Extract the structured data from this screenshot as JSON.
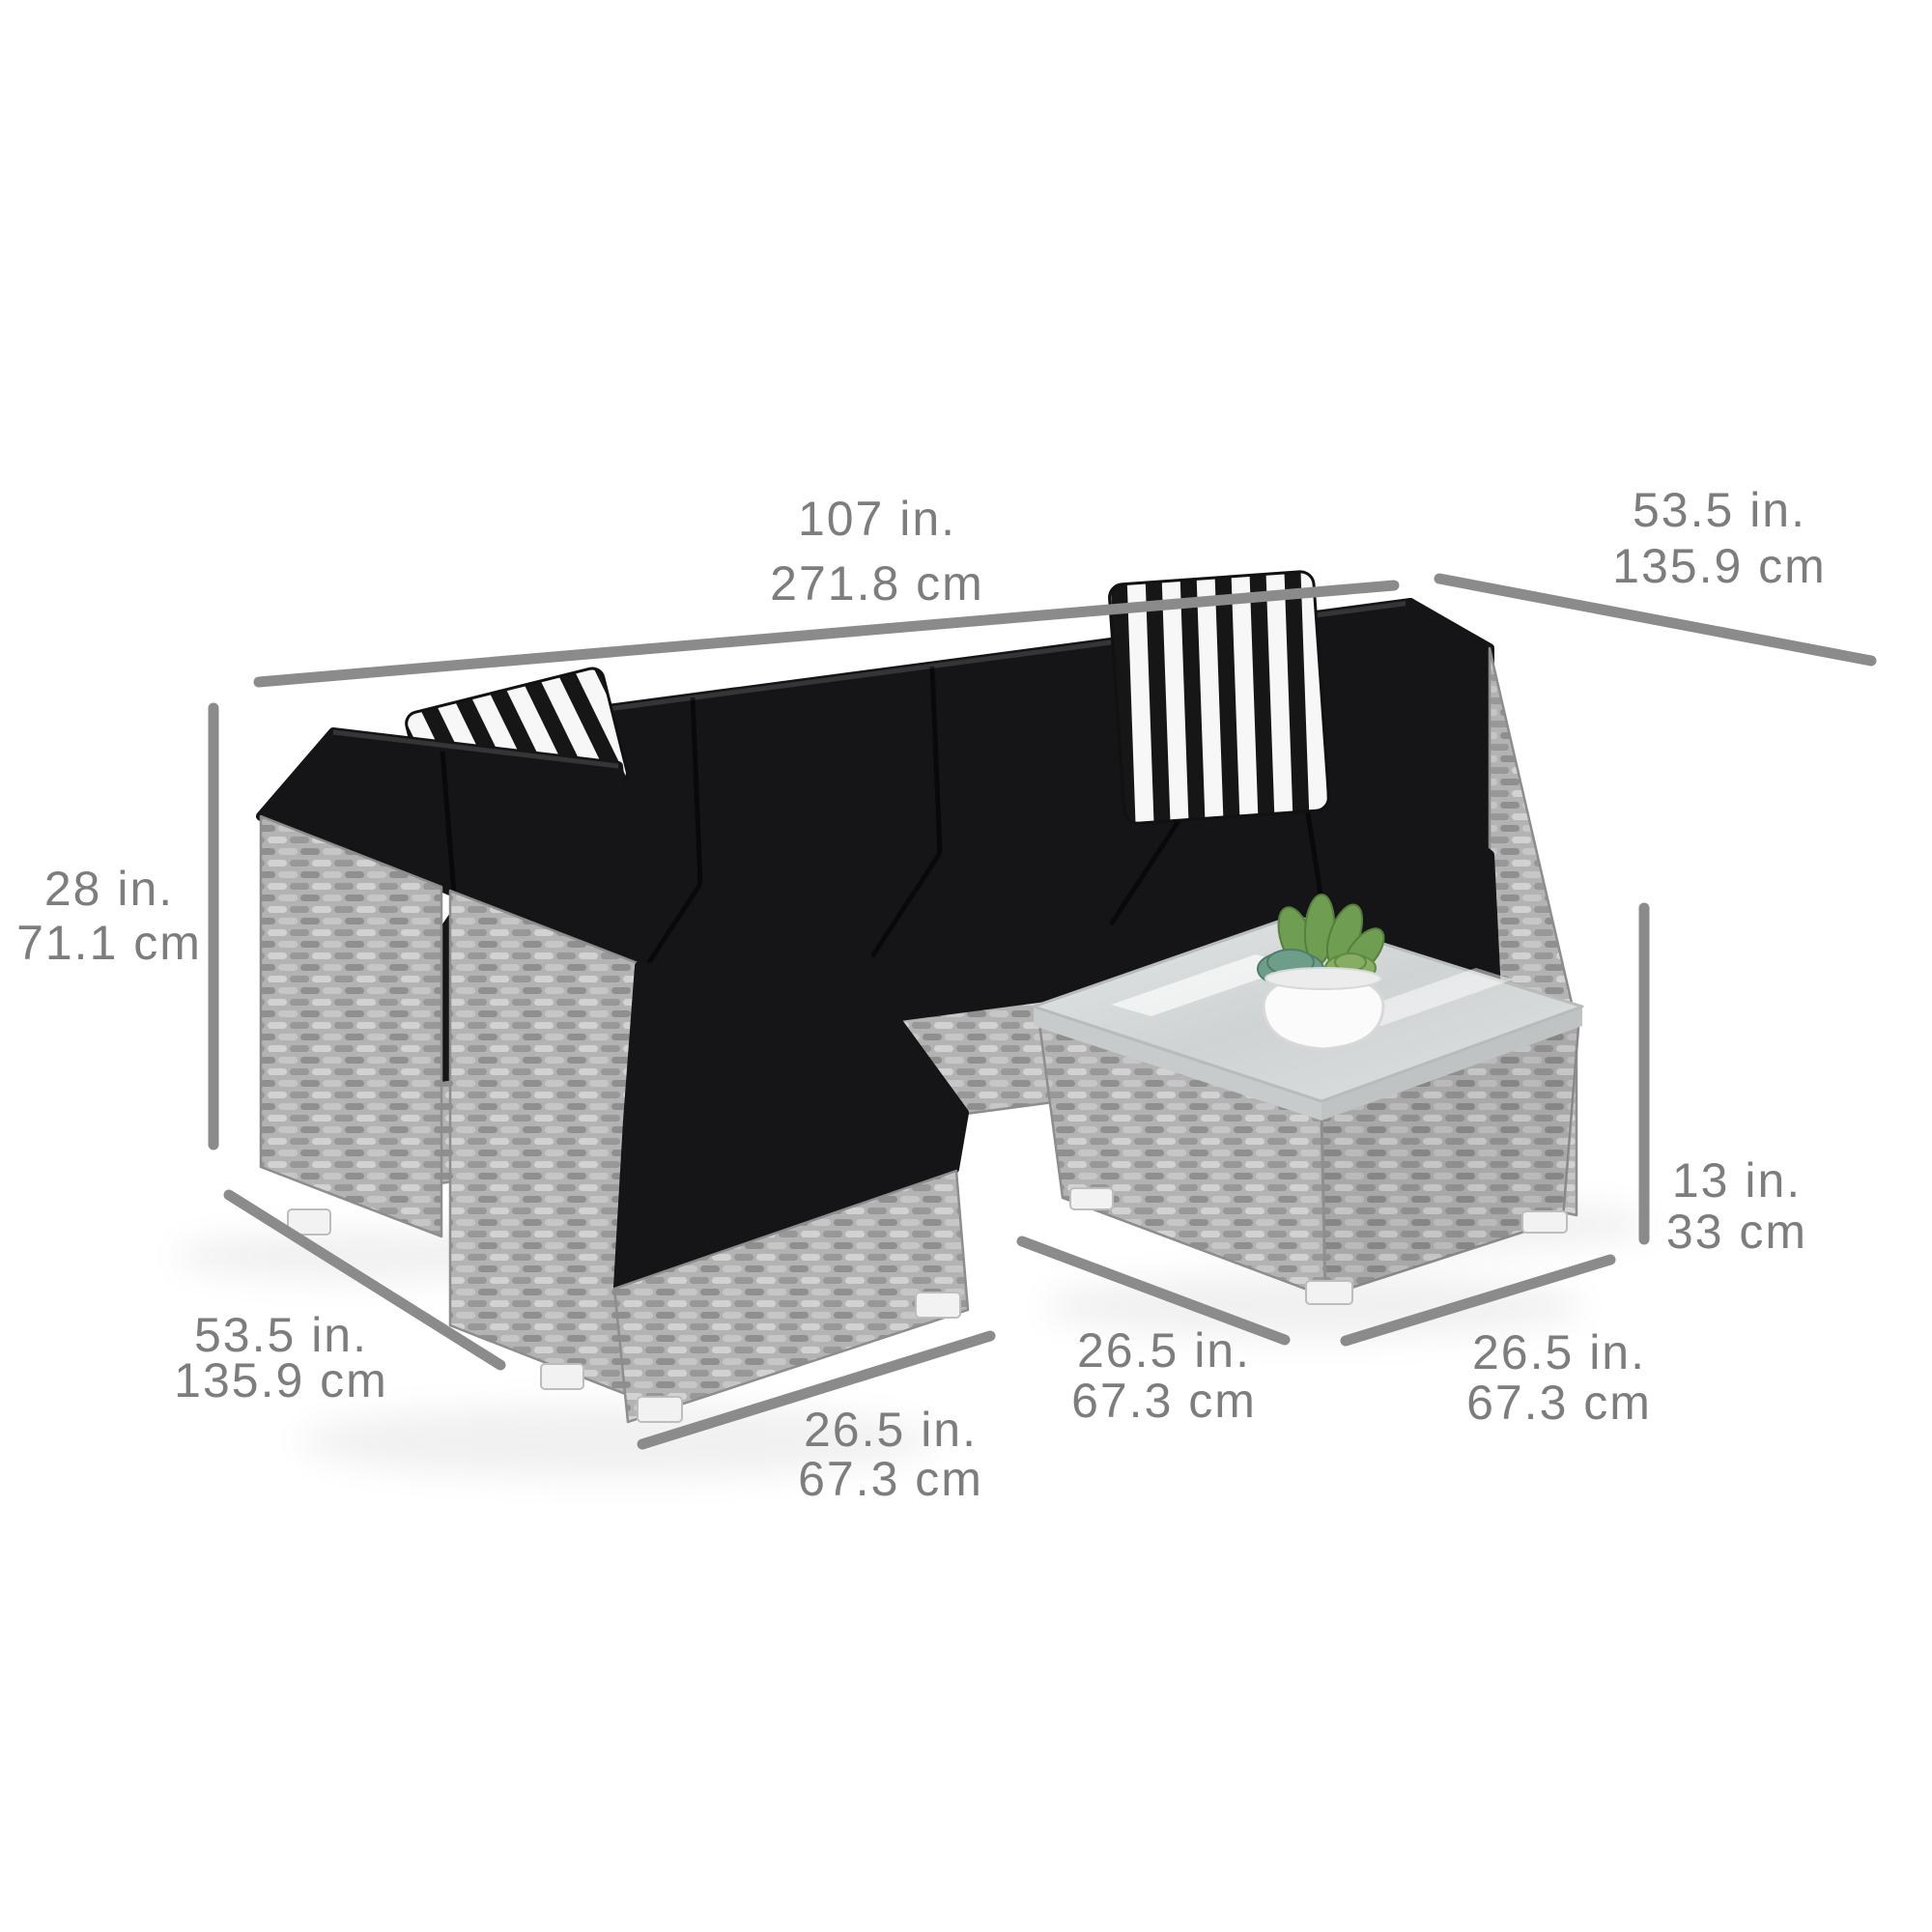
{
  "figure": {
    "kind": "product-dimension-diagram",
    "subject": "7-piece outdoor wicker sectional sofa set with coffee table"
  },
  "scene": {
    "items": [
      "sectional-sofa",
      "striped-throw-pillows",
      "glass-top-coffee-table",
      "succulent-planter"
    ]
  },
  "colors": {
    "background": "#ffffff",
    "dimension_line": "#8b8b8b",
    "dimension_text": "#7d7d7d",
    "cushion_black": "#151517",
    "wicker_gray": "#b3b3b3",
    "foot_white": "#f2f2f2",
    "plant_green": "#6f9e53"
  },
  "dimensions": {
    "sofa_width": {
      "in": "107 in.",
      "cm": "271.8 cm"
    },
    "sofa_depth_right": {
      "in": "53.5 in.",
      "cm": "135.9 cm"
    },
    "sofa_height": {
      "in": "28 in.",
      "cm": "71.1 cm"
    },
    "sofa_depth_left": {
      "in": "53.5 in.",
      "cm": "135.9 cm"
    },
    "seat_width": {
      "in": "26.5 in.",
      "cm": "67.3 cm"
    },
    "table_side_left": {
      "in": "26.5 in.",
      "cm": "67.3 cm"
    },
    "table_side_right": {
      "in": "26.5 in.",
      "cm": "67.3 cm"
    },
    "table_height": {
      "in": "13 in.",
      "cm": "33 cm"
    }
  }
}
